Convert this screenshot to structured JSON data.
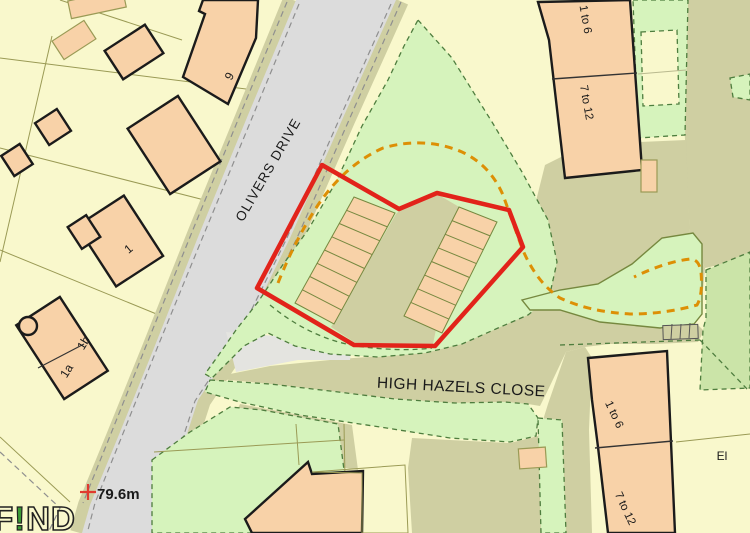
{
  "map": {
    "title": "Site location plan",
    "labels": {
      "olivers_drive": "OLIVERS DRIVE",
      "high_hazels_close": "HIGH HAZELS CLOSE",
      "plot_9": "9",
      "plot_1": "1",
      "plot_1a": "1a",
      "plot_1b": "1b",
      "flats_ne_upper": "1 to 6",
      "flats_ne_lower": "7 to 12",
      "flats_se_upper": "1 to 6",
      "flats_se_lower": "7 to 12",
      "substation": "El",
      "benchmark_height": "79.6m",
      "watermark_f": "F",
      "watermark_i": "!",
      "watermark_nd": "ND"
    },
    "site": {
      "boundary_color_name": "red",
      "parking_rows": 2,
      "parking_bays_per_row": 8
    },
    "colors": {
      "red_boundary": "#e2231a",
      "orange_route": "#dd8f05",
      "green_open": "#d6f3bc",
      "green_dark": "#cbe4a8",
      "green_dash": "#4e7d3e",
      "khaki": "#cfcfa2",
      "road_gray": "#dcdcdc",
      "path_gray": "#e4e4e0",
      "parcel_yellow": "#f9f8cc",
      "parcel_cream": "#fbfadd",
      "building_peach": "#f8d2a8",
      "outline_black": "#1b1b1b",
      "parcel_line": "#9a9a55",
      "olive_line": "#76883f",
      "text": "#1a1a1a",
      "watermark_green": "#3a9a35",
      "benchmark_red": "#e03a2f"
    }
  }
}
